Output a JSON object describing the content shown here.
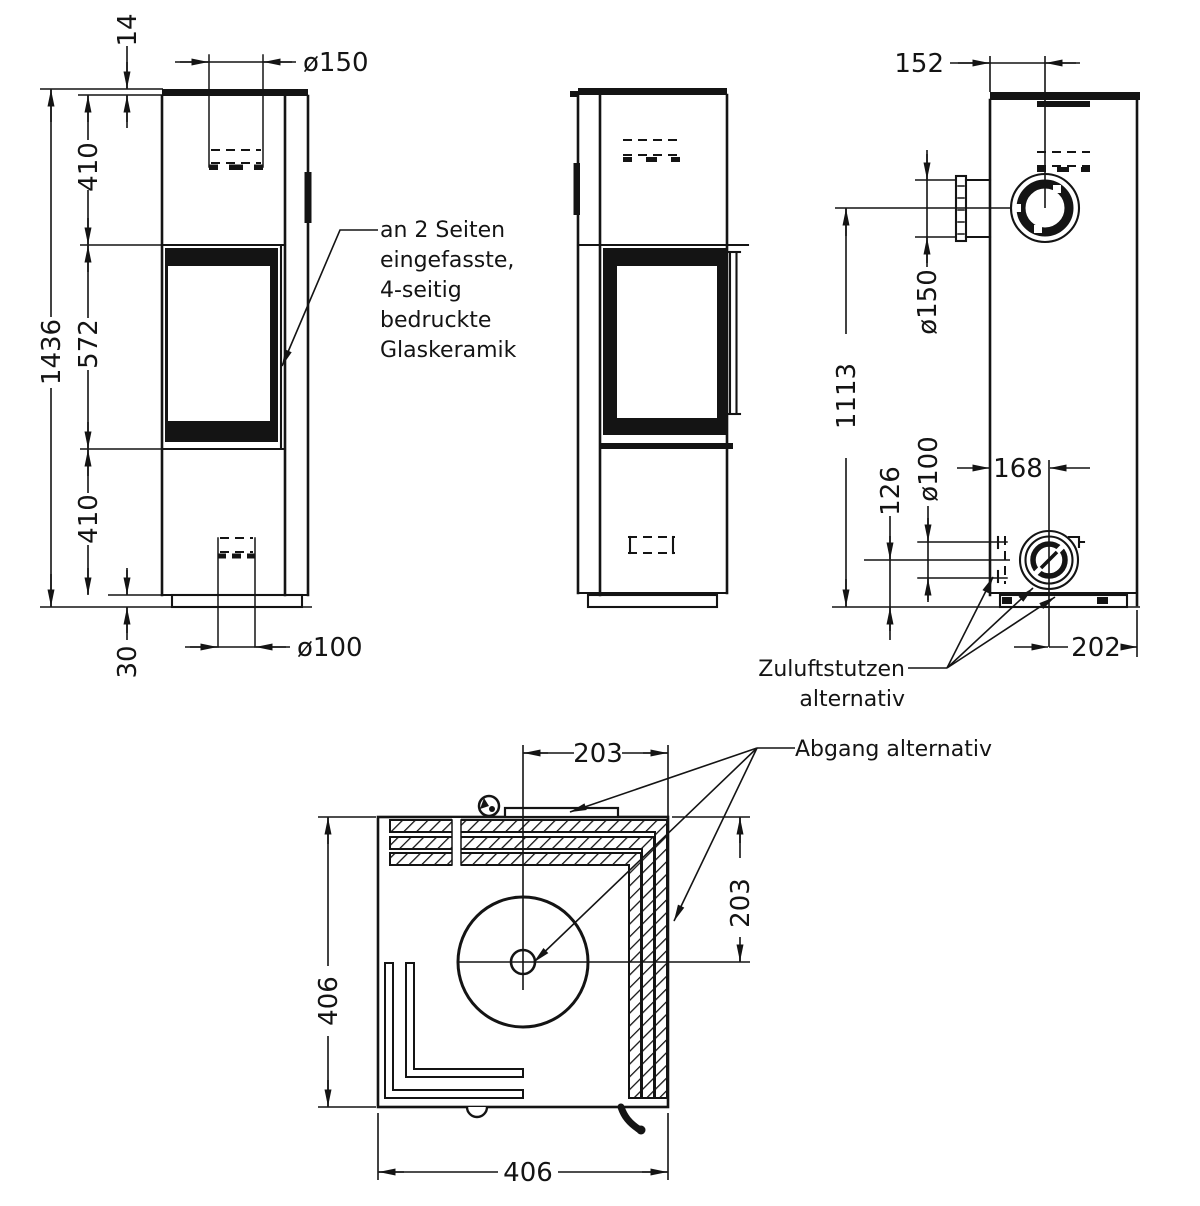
{
  "page": {
    "background": "#ffffff",
    "ink": "#141414"
  },
  "views": {
    "front": {
      "dims": {
        "plate_thickness": "14",
        "upper_height": "410",
        "door_height": "572",
        "lower_height": "410",
        "plinth_height": "30",
        "total_height": "1436",
        "flue_diameter": "ø150",
        "air_diameter": "ø100"
      }
    },
    "rear": {
      "dims": {
        "flue_offset": "152",
        "flue_diameter": "ø150",
        "flue_center_height": "1113",
        "air_center_height": "126",
        "air_diameter": "ø100",
        "air_offset_left": "168",
        "air_offset_right": "202"
      }
    },
    "top": {
      "dims": {
        "center_to_side": "203",
        "depth": "406",
        "center_to_back": "203",
        "width": "406"
      }
    }
  },
  "annotations": {
    "glass_note": {
      "line1": "an 2 Seiten",
      "line2": "eingefasste,",
      "line3": "4-seitig",
      "line4": "bedruckte",
      "line5": "Glaskeramik"
    },
    "air_note": {
      "line1": "Zuluftstutzen",
      "line2": "alternativ"
    },
    "outlet_note": {
      "line1": "Abgang alternativ"
    }
  }
}
